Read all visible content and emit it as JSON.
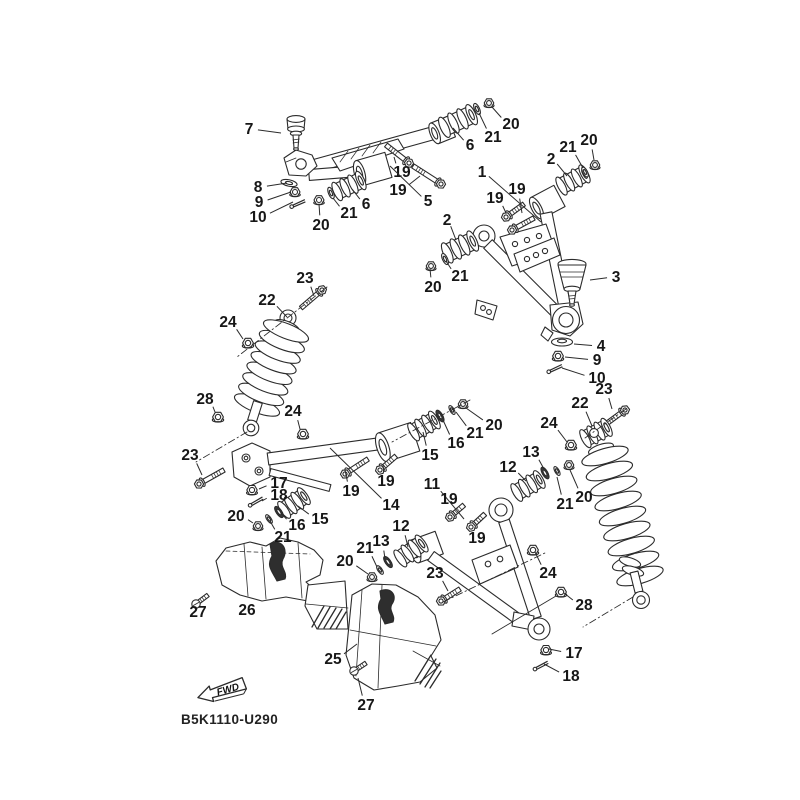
{
  "diagram": {
    "code": "B5K1110-U290",
    "fwd_label": "FWD",
    "colors": {
      "line": "#2b2b2b",
      "label": "#171717",
      "background": "#ffffff",
      "shade": "#2e2e2e"
    },
    "callouts": [
      {
        "n": "7",
        "x": 249,
        "y": 129,
        "lx": 281,
        "ly": 133
      },
      {
        "n": "8",
        "x": 258,
        "y": 187,
        "lx": 287,
        "ly": 183
      },
      {
        "n": "9",
        "x": 259,
        "y": 202,
        "lx": 291,
        "ly": 192
      },
      {
        "n": "10",
        "x": 258,
        "y": 217,
        "lx": 293,
        "ly": 202
      },
      {
        "n": "20",
        "x": 321,
        "y": 225,
        "lx": 319,
        "ly": 204
      },
      {
        "n": "21",
        "x": 349,
        "y": 213,
        "lx": 333,
        "ly": 198
      },
      {
        "n": "6",
        "x": 366,
        "y": 204,
        "lx": 352,
        "ly": 189
      },
      {
        "n": "19",
        "x": 402,
        "y": 172,
        "lx": 394,
        "ly": 157
      },
      {
        "n": "19",
        "x": 398,
        "y": 190,
        "lx": 420,
        "ly": 176
      },
      {
        "n": "5",
        "x": 428,
        "y": 201,
        "lx": 390,
        "ly": 166
      },
      {
        "n": "6",
        "x": 470,
        "y": 145,
        "lx": 453,
        "ly": 128
      },
      {
        "n": "21",
        "x": 493,
        "y": 137,
        "lx": 479,
        "ly": 113
      },
      {
        "n": "20",
        "x": 511,
        "y": 124,
        "lx": 492,
        "ly": 107
      },
      {
        "n": "1",
        "x": 482,
        "y": 172,
        "lx": 541,
        "ly": 222
      },
      {
        "n": "2",
        "x": 551,
        "y": 159,
        "lx": 567,
        "ly": 176
      },
      {
        "n": "21",
        "x": 568,
        "y": 147,
        "lx": 583,
        "ly": 168
      },
      {
        "n": "20",
        "x": 589,
        "y": 140,
        "lx": 594,
        "ly": 160
      },
      {
        "n": "19",
        "x": 495,
        "y": 198,
        "lx": 506,
        "ly": 213
      },
      {
        "n": "19",
        "x": 517,
        "y": 189,
        "lx": 522,
        "ly": 213
      },
      {
        "n": "2",
        "x": 447,
        "y": 220,
        "lx": 456,
        "ly": 240
      },
      {
        "n": "21",
        "x": 460,
        "y": 276,
        "lx": 446,
        "ly": 261
      },
      {
        "n": "20",
        "x": 433,
        "y": 287,
        "lx": 430,
        "ly": 269
      },
      {
        "n": "3",
        "x": 616,
        "y": 277,
        "lx": 590,
        "ly": 280
      },
      {
        "n": "4",
        "x": 601,
        "y": 346,
        "lx": 574,
        "ly": 344
      },
      {
        "n": "9",
        "x": 597,
        "y": 360,
        "lx": 565,
        "ly": 357
      },
      {
        "n": "10",
        "x": 597,
        "y": 378,
        "lx": 562,
        "ly": 368
      },
      {
        "n": "23",
        "x": 305,
        "y": 278,
        "lx": 314,
        "ly": 296
      },
      {
        "n": "22",
        "x": 267,
        "y": 300,
        "lx": 287,
        "ly": 317
      },
      {
        "n": "24",
        "x": 228,
        "y": 322,
        "lx": 243,
        "ly": 339
      },
      {
        "n": "28",
        "x": 205,
        "y": 399,
        "lx": 215,
        "ly": 412
      },
      {
        "n": "24",
        "x": 293,
        "y": 411,
        "lx": 300,
        "ly": 429
      },
      {
        "n": "23",
        "x": 190,
        "y": 455,
        "lx": 202,
        "ly": 475
      },
      {
        "n": "17",
        "x": 279,
        "y": 483,
        "lx": 259,
        "ly": 489
      },
      {
        "n": "18",
        "x": 279,
        "y": 495,
        "lx": 262,
        "ly": 501
      },
      {
        "n": "20",
        "x": 236,
        "y": 516,
        "lx": 253,
        "ly": 523
      },
      {
        "n": "16",
        "x": 297,
        "y": 525,
        "lx": 281,
        "ly": 513
      },
      {
        "n": "21",
        "x": 283,
        "y": 537,
        "lx": 270,
        "ly": 521
      },
      {
        "n": "15",
        "x": 320,
        "y": 519,
        "lx": 298,
        "ly": 506
      },
      {
        "n": "19",
        "x": 351,
        "y": 491,
        "lx": 345,
        "ly": 470
      },
      {
        "n": "19",
        "x": 386,
        "y": 481,
        "lx": 383,
        "ly": 465
      },
      {
        "n": "14",
        "x": 391,
        "y": 505,
        "lx": 330,
        "ly": 448
      },
      {
        "n": "15",
        "x": 430,
        "y": 455,
        "lx": 423,
        "ly": 432
      },
      {
        "n": "16",
        "x": 456,
        "y": 443,
        "lx": 443,
        "ly": 420
      },
      {
        "n": "21",
        "x": 475,
        "y": 433,
        "lx": 456,
        "ly": 412
      },
      {
        "n": "20",
        "x": 494,
        "y": 425,
        "lx": 466,
        "ly": 408
      },
      {
        "n": "11",
        "x": 432,
        "y": 484,
        "lx": 464,
        "ly": 519
      },
      {
        "n": "19",
        "x": 449,
        "y": 499,
        "lx": 452,
        "ly": 511
      },
      {
        "n": "19",
        "x": 477,
        "y": 538,
        "lx": 473,
        "ly": 526
      },
      {
        "n": "12",
        "x": 508,
        "y": 467,
        "lx": 526,
        "ly": 481
      },
      {
        "n": "13",
        "x": 531,
        "y": 452,
        "lx": 544,
        "ly": 469
      },
      {
        "n": "21",
        "x": 565,
        "y": 504,
        "lx": 557,
        "ly": 477
      },
      {
        "n": "20",
        "x": 584,
        "y": 497,
        "lx": 570,
        "ly": 470
      },
      {
        "n": "24",
        "x": 549,
        "y": 423,
        "lx": 567,
        "ly": 442
      },
      {
        "n": "22",
        "x": 580,
        "y": 403,
        "lx": 592,
        "ly": 426
      },
      {
        "n": "23",
        "x": 604,
        "y": 389,
        "lx": 612,
        "ly": 409
      },
      {
        "n": "12",
        "x": 401,
        "y": 526,
        "lx": 408,
        "ly": 547
      },
      {
        "n": "13",
        "x": 381,
        "y": 541,
        "lx": 385,
        "ly": 559
      },
      {
        "n": "21",
        "x": 365,
        "y": 548,
        "lx": 377,
        "ly": 567
      },
      {
        "n": "20",
        "x": 345,
        "y": 561,
        "lx": 368,
        "ly": 574
      },
      {
        "n": "23",
        "x": 435,
        "y": 573,
        "lx": 448,
        "ly": 591
      },
      {
        "n": "24",
        "x": 548,
        "y": 573,
        "lx": 535,
        "ly": 552
      },
      {
        "n": "28",
        "x": 584,
        "y": 605,
        "lx": 564,
        "ly": 593
      },
      {
        "n": "17",
        "x": 574,
        "y": 653,
        "lx": 549,
        "ly": 649
      },
      {
        "n": "18",
        "x": 571,
        "y": 676,
        "lx": 544,
        "ly": 664
      },
      {
        "n": "26",
        "x": 247,
        "y": 610,
        "lx": 254,
        "ly": 598
      },
      {
        "n": "27",
        "x": 198,
        "y": 612,
        "lx": 198,
        "ly": 604
      },
      {
        "n": "25",
        "x": 333,
        "y": 659,
        "lx": 357,
        "ly": 644
      },
      {
        "n": "27",
        "x": 366,
        "y": 705,
        "lx": 358,
        "ly": 678
      }
    ]
  }
}
